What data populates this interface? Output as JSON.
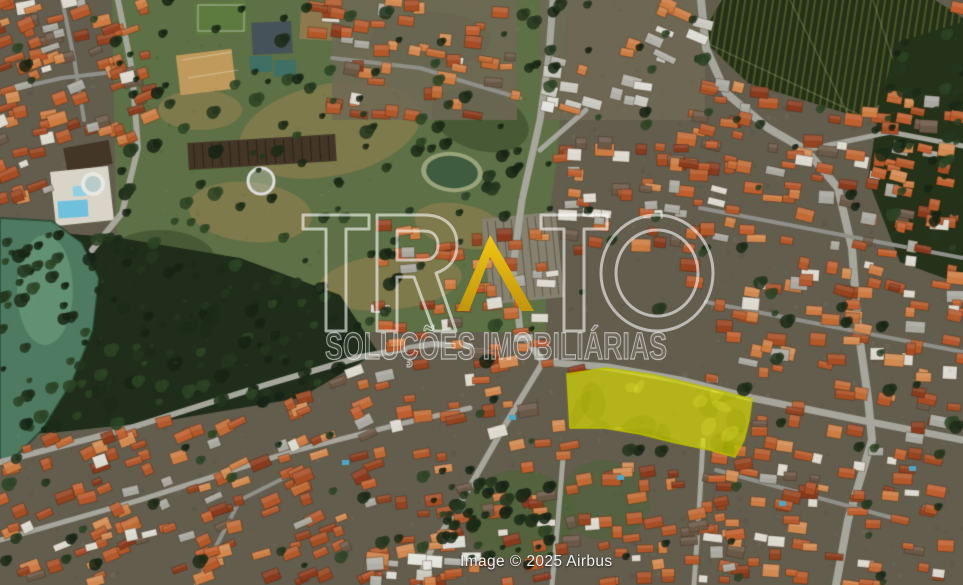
{
  "meta": {
    "view": "satellite aerial photograph of a residential neighborhood with a highlighted land parcel",
    "width": 963,
    "height": 585
  },
  "watermark": {
    "brand": "TRATO",
    "tagline": "SOLUÇÕES IMOBILIÁRIAS",
    "brand_color": "rgba(255,255,255,0.58)",
    "tagline_color": "rgba(255,255,255,0.55)",
    "accent_gold_top": "#f1c713",
    "accent_gold_bottom": "#c2950a"
  },
  "attribution": {
    "text": "Image © 2025 Airbus"
  },
  "highlight_parcel": {
    "fill": "rgba(222,225,0,0.66)",
    "border": "rgba(186,190,0,0.95)",
    "points": [
      [
        567,
        374
      ],
      [
        606,
        368
      ],
      [
        654,
        375
      ],
      [
        704,
        387
      ],
      [
        752,
        399
      ],
      [
        749,
        420
      ],
      [
        744,
        440
      ],
      [
        735,
        457
      ],
      [
        710,
        450
      ],
      [
        676,
        443
      ],
      [
        640,
        434
      ],
      [
        604,
        428
      ],
      [
        570,
        428
      ]
    ]
  },
  "map": {
    "palette": {
      "ground": "#635d4e",
      "road": "#a6a69c",
      "road_minor": "#90908a",
      "park": "#5e7045",
      "park_dry": "rgba(148,128,82,0.6)",
      "park_dark": "rgba(52,72,40,0.55)",
      "forest": "#1f2d1a",
      "forest_right": "#243219",
      "orchard": "#262f17",
      "orchard_row": "rgba(104,128,56,0.5)",
      "orchard_line": "rgba(170,180,130,0.3)",
      "lake": "#4e7a62",
      "lake_light": "rgba(116,165,130,0.5)",
      "pond": "#3f5c40",
      "pond_rim": "#9aa37a",
      "pool_blue": "#6fc0dc",
      "pool_blue2": "#4aa8c8",
      "deck_white": "#d8d5c8",
      "building_dark": "#443626",
      "building_ridge": "#2c2218",
      "building_gray": "#87816f",
      "court_tan": "#c09a5c",
      "court_dark": "#46525a",
      "court_green": "#3e7066",
      "field_green": "#5d7a3f",
      "field_tan": "#8c7a4e",
      "roofs": [
        "#b4582a",
        "#b4582a",
        "#c16a34",
        "#a74d24",
        "#cd7c42",
        "#96431f",
        "#d28a50",
        "#8a3a1c",
        "#c05f2e",
        "#b4582a",
        "#dcd9cf",
        "#a8a8a0",
        "#6b5948"
      ],
      "roofs_light": [
        "#dcdcd4",
        "#c8c8c0",
        "#e4e4de",
        "#b0b0a8",
        "#cd7c42"
      ],
      "trees": [
        "#1c2b18",
        "#24361e",
        "#2d4424",
        "#182415"
      ],
      "noise": [
        "rgba(255,255,255,0.045)",
        "rgba(0,0,0,0.055)",
        "rgba(130,110,70,0.06)"
      ]
    }
  }
}
